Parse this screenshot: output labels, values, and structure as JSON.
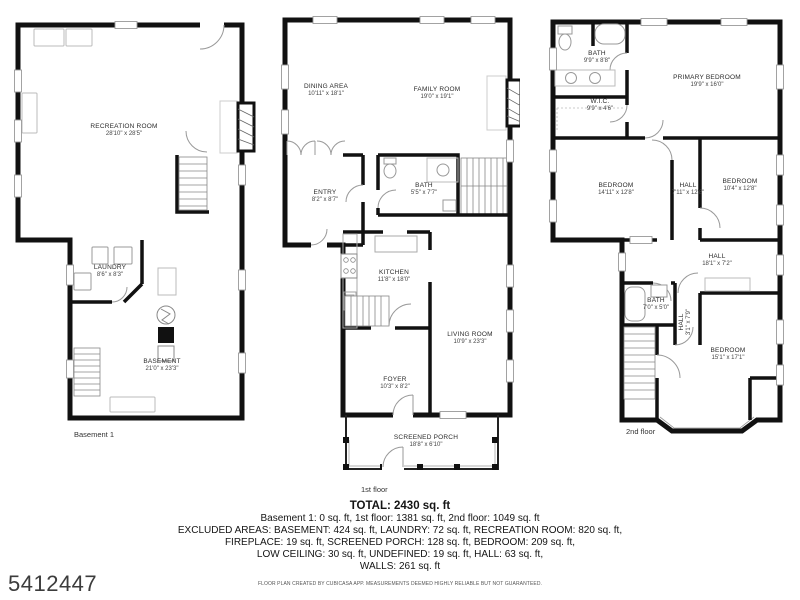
{
  "plan_id": "5412447",
  "footer_note": "FLOOR PLAN CREATED BY CUBICASA APP. MEASUREMENTS DEEMED HIGHLY RELIABLE BUT NOT GUARANTEED.",
  "colors": {
    "wall": "#111111",
    "background": "#ffffff",
    "furniture": "#aaaaaa"
  },
  "summary": {
    "total": "TOTAL: 2430 sq. ft",
    "line1": "Basement 1: 0 sq. ft, 1st floor: 1381 sq. ft, 2nd floor: 1049 sq. ft",
    "line2": "EXCLUDED AREAS: BASEMENT: 424 sq. ft, LAUNDRY: 72 sq. ft, RECREATION ROOM: 820 sq. ft,",
    "line3": "FIREPLACE: 19 sq. ft, SCREENED PORCH: 128 sq. ft, BEDROOM: 209 sq. ft,",
    "line4": "LOW CEILING: 30 sq. ft, UNDEFINED: 19 sq. ft, HALL: 63 sq. ft,",
    "line5": "WALLS: 261 sq. ft"
  },
  "floors": {
    "basement": {
      "label": "Basement 1",
      "rooms": {
        "recreation": {
          "name": "RECREATION ROOM",
          "dims": "28'10\" x 28'5\""
        },
        "laundry": {
          "name": "LAUNDRY",
          "dims": "8'6\" x 8'3\""
        },
        "basement": {
          "name": "BASEMENT",
          "dims": "21'0\" x 23'3\""
        }
      }
    },
    "first": {
      "label": "1st floor",
      "rooms": {
        "dining": {
          "name": "DINING AREA",
          "dims": "10'11\" x 18'1\""
        },
        "family": {
          "name": "FAMILY ROOM",
          "dims": "19'0\" x 19'1\""
        },
        "entry": {
          "name": "ENTRY",
          "dims": "8'2\" x 8'7\""
        },
        "bath": {
          "name": "BATH",
          "dims": "5'5\" x 7'7\""
        },
        "kitchen": {
          "name": "KITCHEN",
          "dims": "11'8\" x 18'0\""
        },
        "living": {
          "name": "LIVING ROOM",
          "dims": "10'9\" x 23'3\""
        },
        "foyer": {
          "name": "FOYER",
          "dims": "10'3\" x 8'2\""
        },
        "porch": {
          "name": "SCREENED PORCH",
          "dims": "18'8\" x 6'10\""
        }
      }
    },
    "second": {
      "label": "2nd floor",
      "rooms": {
        "bath": {
          "name": "BATH",
          "dims": "9'9\" x 8'8\""
        },
        "wic": {
          "name": "W.I.C.",
          "dims": "9'9\" x 4'6\""
        },
        "primary": {
          "name": "PRIMARY BEDROOM",
          "dims": "19'9\" x 16'0\""
        },
        "bedroom_left": {
          "name": "BEDROOM",
          "dims": "14'11\" x 12'8\""
        },
        "hall_mid": {
          "name": "HALL",
          "dims": "7'11\" x 12'8\""
        },
        "bedroom_right": {
          "name": "BEDROOM",
          "dims": "10'4\" x 12'8\""
        },
        "hall_upper": {
          "name": "HALL",
          "dims": "18'1\" x 7'2\""
        },
        "bath_small": {
          "name": "BATH",
          "dims": "7'0\" x 5'0\""
        },
        "hall_small": {
          "name": "HALL",
          "dims": "3'1\" x 7'9\""
        },
        "bedroom_bottom": {
          "name": "BEDROOM",
          "dims": "15'1\" x 17'1\""
        }
      }
    }
  }
}
